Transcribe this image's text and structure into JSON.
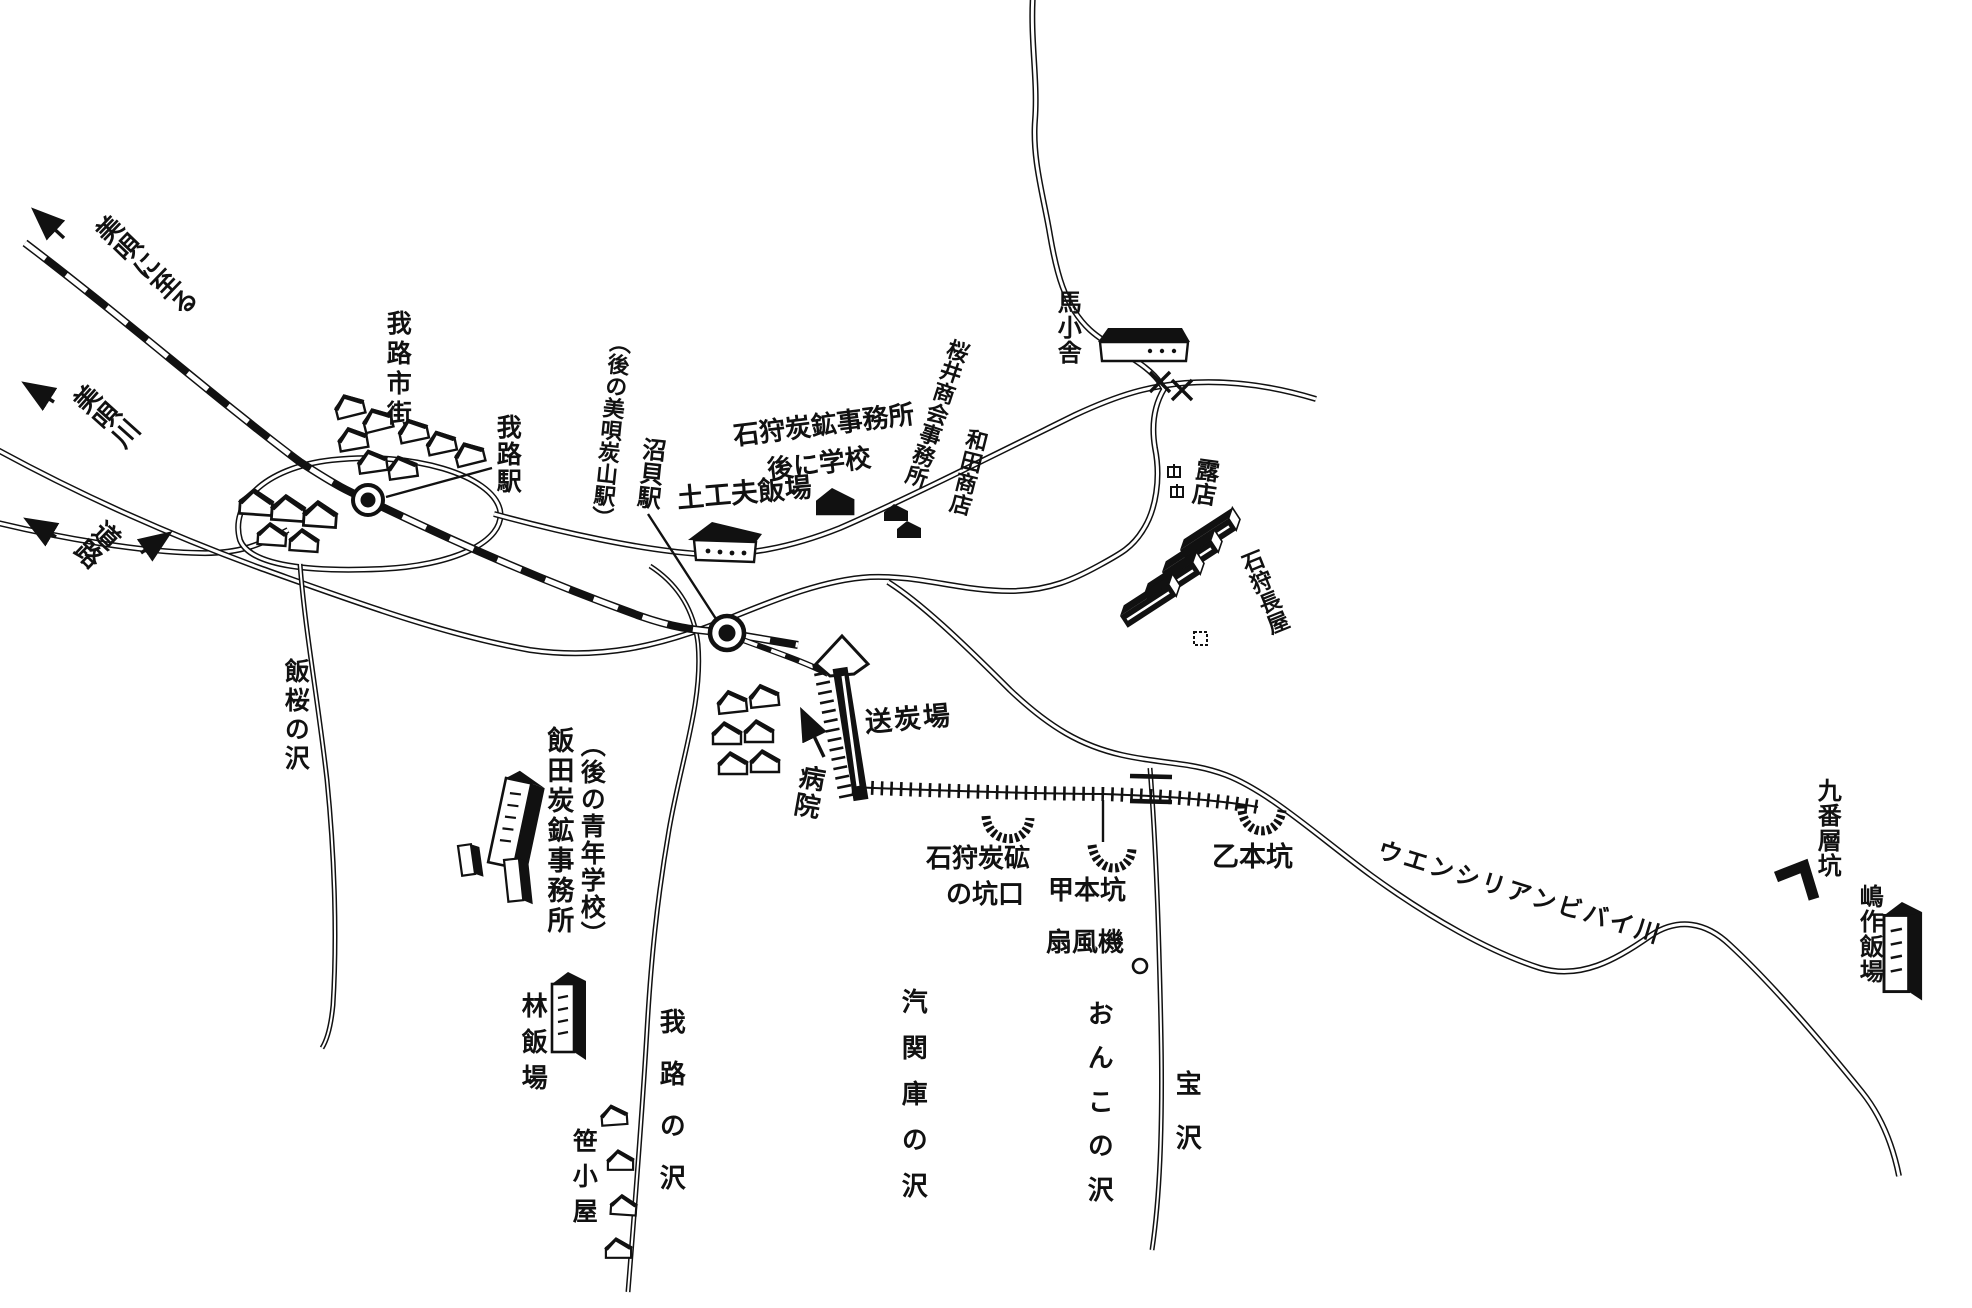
{
  "canvas": {
    "background": "#ffffff",
    "ink": "#111111",
    "kind": "hand-drawn coal mining area map (Gamuro / Bibai, Japanese)"
  },
  "labels": {
    "to_bibai": "美唄に至る",
    "bibai_river": "美唄川",
    "road": "道路",
    "gamuro_town": "我路市街",
    "gamuro_station": "我路駅",
    "numakai_note": "（後の美唄炭山駅）",
    "numakai_station": "沼貝駅",
    "ishikari_coal_office": "石狩炭鉱事務所",
    "ishikari_coal_office_note": "後に学校",
    "dokofu_hanba": "土工夫飯場",
    "sakurai_shokai_office": "桜井商会事務所",
    "wada_shoten": "和田商店",
    "horse_shed": "馬小舎",
    "roten": "露店",
    "ishikari_nagaya": "石狩長屋",
    "sotanba": "送炭場",
    "hospital": "病院",
    "iida_office": "飯田炭鉱事務所",
    "iida_office_note": "（後の青年学校）",
    "hayashi_hanba": "林飯場",
    "sasagoya": "笹小屋",
    "hanzakura_sawa": "飯桜の沢",
    "gamuro_sawa": "我路の沢",
    "kikanko_sawa": "汽関庫の沢",
    "onko_sawa": "おんこの沢",
    "takarasawa": "宝沢",
    "ishikari_pit_line1": "石狩炭砿",
    "ishikari_pit_line2": "の坑口",
    "ko_hon_ko": "甲本坑",
    "otsu_hon_ko": "乙本坑",
    "fan": "扇風機",
    "uenshiri_river": "ウエンシリアンビバイ川",
    "kyubanso_ko": "九番層坑",
    "shimasaku_hanba": "嶋作飯場"
  },
  "icons": {
    "station-icon": "circled dot on railway",
    "house-icon": "small gabled hut",
    "black-house-icon": "solid black hut",
    "rowhouse-icon": "long black nagaya block",
    "tall-building-icon": "3D office block with window dots",
    "mine-entrance-icon": "hatched U portal",
    "bridge-icon": "X / double bar crossing",
    "fan-icon": "small circle (ventilation fan)",
    "stall-icon": "tiny stall square",
    "arrow-icon": "direction arrow"
  }
}
